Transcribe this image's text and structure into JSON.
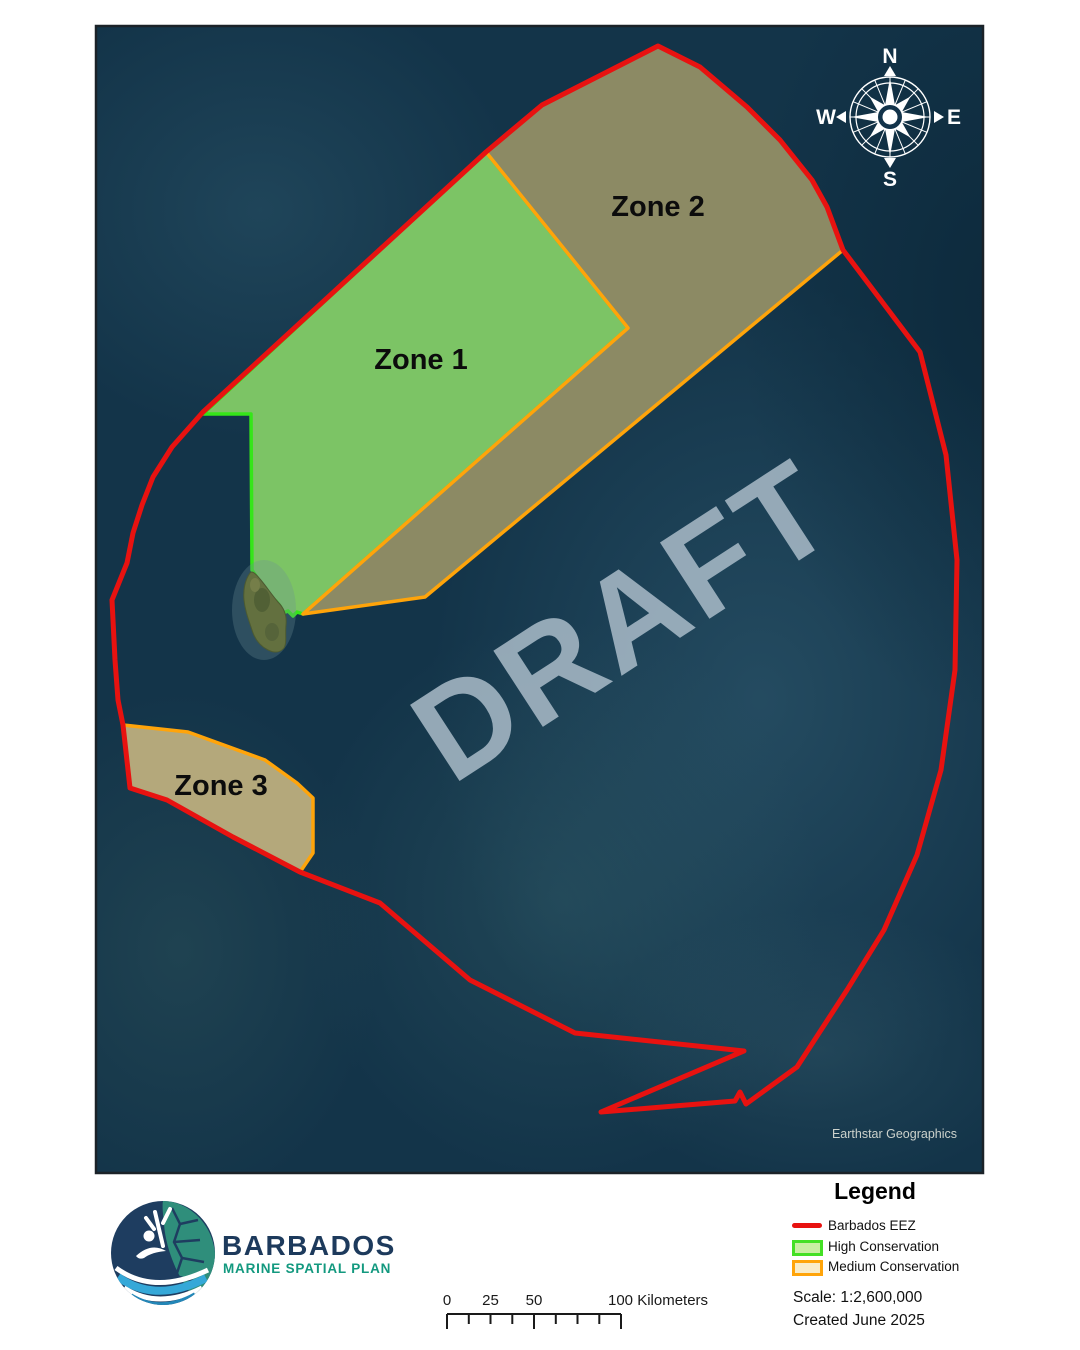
{
  "map": {
    "watermark": "DRAFT",
    "attribution": "Earthstar Geographics",
    "zones": [
      {
        "label": "Zone 1",
        "category": "High Conservation"
      },
      {
        "label": "Zone 2",
        "category": "Medium Conservation"
      },
      {
        "label": "Zone 3",
        "category": "Medium Conservation"
      }
    ],
    "compass": {
      "n": "N",
      "e": "E",
      "s": "S",
      "w": "W"
    }
  },
  "legend": {
    "title": "Legend",
    "items": [
      {
        "label": "Barbados EEZ",
        "swatch": "red-line",
        "color": "#e81210"
      },
      {
        "label": "High Conservation",
        "swatch": "green-rect",
        "fill": "#c9efa3",
        "border": "#44e025"
      },
      {
        "label": "Medium Conservation",
        "swatch": "tan-rect",
        "fill": "#f9ecc9",
        "border": "#ffa40a"
      }
    ],
    "scale_text": "Scale: 1:2,600,000",
    "created_text": "Created June 2025"
  },
  "scalebar": {
    "labels": [
      "0",
      "25",
      "50"
    ],
    "end_label": "100 Kilometers"
  },
  "logo": {
    "title": "BARBADOS",
    "subtitle": "MARINE SPATIAL PLAN"
  },
  "colors": {
    "ocean": "#133449",
    "eez_line": "#e81210",
    "zone1_fill": "#7cc465",
    "zone1_border": "#35e619",
    "zone2_fill": "#8c8a64",
    "zone3_fill": "#b4a87b",
    "medium_border": "#ffa40a",
    "draft_watermark": "#a9bbc8",
    "logo_navy": "#1d3a5c",
    "logo_teal": "#13997f"
  }
}
